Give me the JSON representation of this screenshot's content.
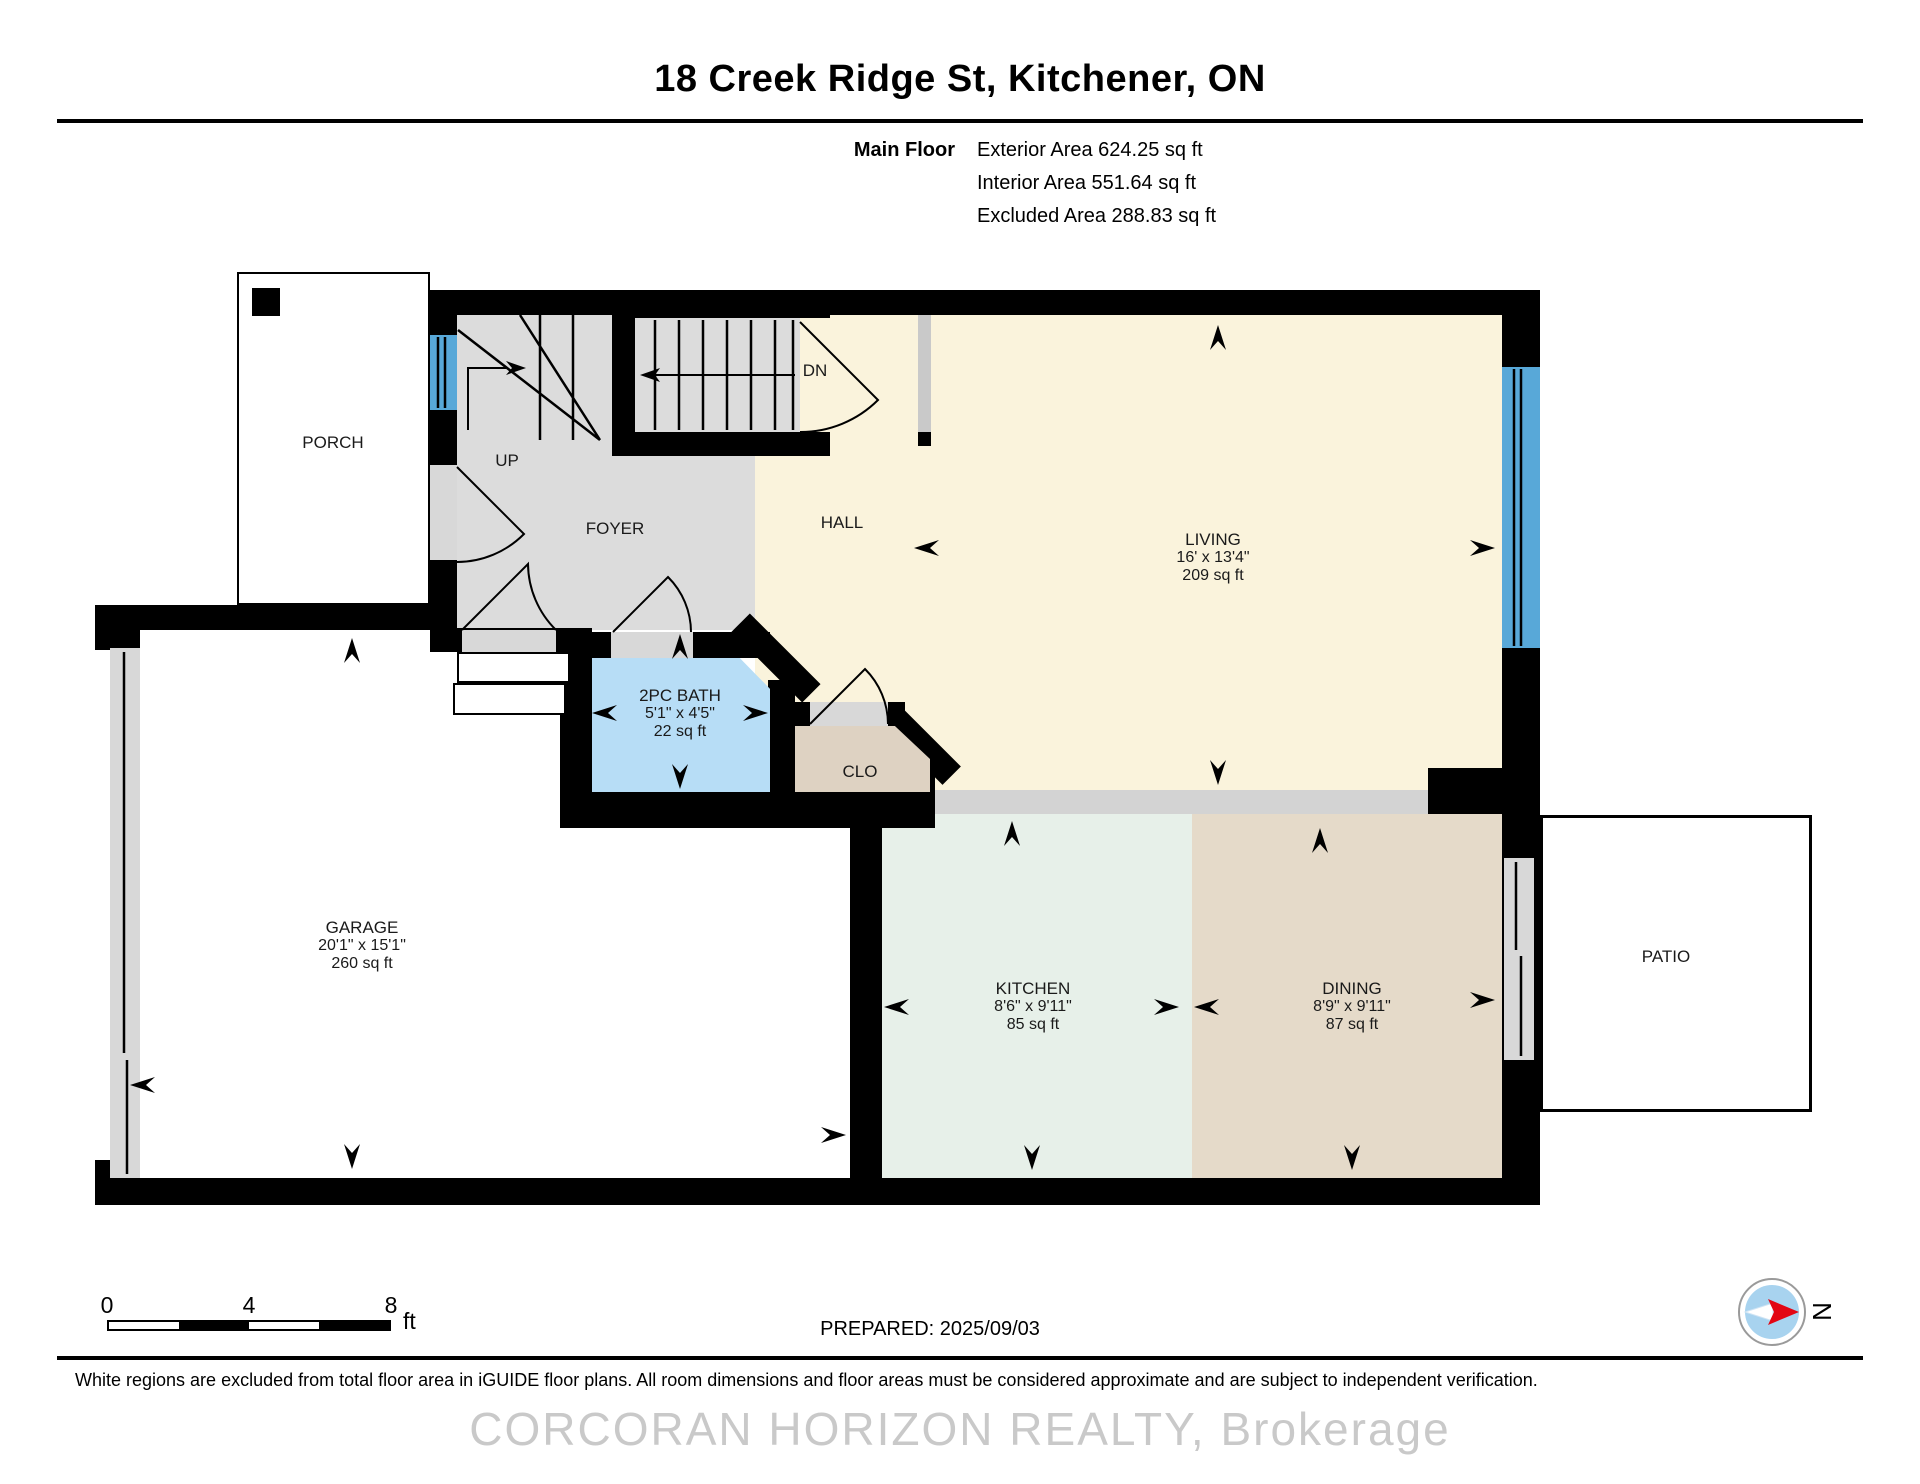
{
  "title": "18 Creek Ridge St, Kitchener, ON",
  "header": {
    "floor_label": "Main Floor",
    "exterior": "Exterior Area 624.25 sq ft",
    "interior": "Interior Area 551.64 sq ft",
    "excluded": "Excluded Area 288.83 sq ft"
  },
  "rooms": {
    "porch": {
      "label": "PORCH"
    },
    "foyer": {
      "label": "FOYER"
    },
    "up": {
      "label": "UP"
    },
    "dn": {
      "label": "DN"
    },
    "hall": {
      "label": "HALL"
    },
    "living": {
      "label": "LIVING",
      "dims": "16' x 13'4\"",
      "area": "209 sq ft"
    },
    "bath": {
      "label": "2PC BATH",
      "dims": "5'1\" x 4'5\"",
      "area": "22 sq ft"
    },
    "clo": {
      "label": "CLO"
    },
    "garage": {
      "label": "GARAGE",
      "dims": "20'1\" x 15'1\"",
      "area": "260 sq ft"
    },
    "kitchen": {
      "label": "KITCHEN",
      "dims": "8'6\" x 9'11\"",
      "area": "85 sq ft"
    },
    "dining": {
      "label": "DINING",
      "dims": "8'9\" x 9'11\"",
      "area": "87 sq ft"
    },
    "patio": {
      "label": "PATIO"
    }
  },
  "scale_bar": {
    "tick0": "0",
    "tick1": "4",
    "tick2": "8",
    "unit": "ft"
  },
  "prepared": "PREPARED: 2025/09/03",
  "compass": {
    "label": "N"
  },
  "footer": {
    "disclaimer": "White regions are excluded from total floor area in iGUIDE floor plans. All room dimensions and floor areas must be considered approximate and are subject to independent verification.",
    "watermark": "CORCORAN HORIZON REALTY, Brokerage"
  },
  "colors": {
    "living_cream": "#faf3dc",
    "foyer_gray": "#dcdcdc",
    "bath_blue": "#b7ddf6",
    "clo_tan": "#ded2c2",
    "dining_tan": "#e5dac9",
    "kitchen_mint": "#e7f0e9",
    "window_blue": "#58a8d8",
    "compass_blue": "#a8d3ef",
    "compass_red": "#e30613",
    "watermark_gray": "#c9c9c9"
  }
}
